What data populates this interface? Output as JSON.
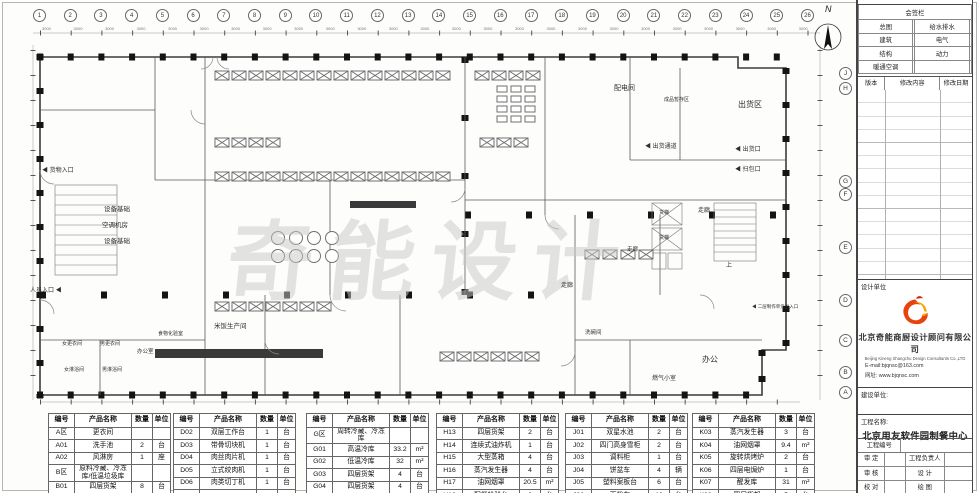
{
  "sheet": {
    "north_label": "N",
    "watermark": "奇能设计",
    "grid_top": [
      "1",
      "2",
      "3",
      "4",
      "5",
      "6",
      "7",
      "8",
      "9",
      "10",
      "11",
      "12",
      "13",
      "14",
      "15",
      "16",
      "17",
      "18",
      "19",
      "20",
      "21",
      "22",
      "23",
      "24",
      "25",
      "26"
    ],
    "dims": [
      "3000",
      "3000",
      "3000",
      "3000",
      "3000",
      "3000",
      "3000",
      "3000",
      "3000",
      "3000",
      "3000",
      "3000",
      "3000",
      "3000",
      "3000",
      "3000",
      "3000",
      "3000",
      "3000",
      "3000",
      "3000",
      "3000",
      "3000",
      "3000",
      "3000"
    ],
    "grid_right": [
      "J",
      "H",
      "G",
      "F",
      "E",
      "D",
      "C",
      "B",
      "A"
    ]
  },
  "plan": {
    "labels": {
      "power_room": "配电间",
      "product_storage": "成品暂存区",
      "shipping_area": "出货区",
      "shipping_channel": "◀ 出货通道",
      "shipping_port": "◀ 出货口",
      "pickup_port": "◀ 扫包口",
      "corridor1": "走廊",
      "corridor2": "走廊",
      "corridor3": "走廊",
      "freight_lift1": "货梯",
      "freight_lift2": "货梯",
      "stairs_up": "上",
      "office": "办公",
      "gas_room": "燃气小室",
      "unit_entrance": "◀ 二层制作单元出入口",
      "equip_base1": "设备基础",
      "ac_room": "空调机房",
      "equip_base2": "设备基础",
      "goods_entrance": "◀ 货物入口",
      "personnel_entrance": "人员入口 ◀",
      "women_changing": "女更衣间",
      "men_changing": "男更衣间",
      "women_shower": "女淋浴间",
      "men_shower": "男淋浴间",
      "office2": "办公室",
      "lab": "食物化验室",
      "rice_room": "米饭生产间",
      "dish_wash": "洗碗间"
    }
  },
  "equipment_tables": {
    "headers": [
      "编号",
      "产品名称",
      "数量",
      "单位"
    ],
    "tables": [
      {
        "rows": [
          [
            "A区",
            "更衣间",
            "",
            ""
          ],
          [
            "A01",
            "洗手池",
            "2",
            "台"
          ],
          [
            "A02",
            "风淋房",
            "1",
            "座"
          ],
          [
            "B区",
            "原料冷藏、冷冻库/低温垃圾库",
            "",
            ""
          ],
          [
            "B01",
            "四层货架",
            "8",
            "台"
          ]
        ]
      },
      {
        "rows": [
          [
            "D02",
            "双层工作台",
            "1",
            "台"
          ],
          [
            "D03",
            "带骨切块机",
            "1",
            "台"
          ],
          [
            "D04",
            "肉丝肉片机",
            "1",
            "台"
          ],
          [
            "D05",
            "立式绞肉机",
            "1",
            "台"
          ],
          [
            "D06",
            "肉类切丁机",
            "1",
            "台"
          ],
          [
            "",
            "",
            "",
            ""
          ]
        ]
      },
      {
        "rows": [
          [
            "G区",
            "周转冷藏、冷冻库",
            "",
            ""
          ],
          [
            "G01",
            "高温冷库",
            "33.2",
            "m²"
          ],
          [
            "G02",
            "低温冷库",
            "32",
            "m²"
          ],
          [
            "G03",
            "四层货架",
            "4",
            "台"
          ],
          [
            "G04",
            "四层货架",
            "4",
            "台"
          ]
        ]
      },
      {
        "rows": [
          [
            "H13",
            "四层货架",
            "2",
            "台"
          ],
          [
            "H14",
            "连续式油炸机",
            "1",
            "台"
          ],
          [
            "H15",
            "大型蒸箱",
            "4",
            "台"
          ],
          [
            "H16",
            "蒸汽发生器",
            "4",
            "台"
          ],
          [
            "H17",
            "油网烟罩",
            "20.5",
            "m²"
          ],
          [
            "H18",
            "配餐检验台",
            "2",
            "台"
          ]
        ]
      },
      {
        "rows": [
          [
            "J01",
            "双星水池",
            "2",
            "台"
          ],
          [
            "J02",
            "四门高身雪柜",
            "2",
            "台"
          ],
          [
            "J03",
            "调料柜",
            "1",
            "台"
          ],
          [
            "J04",
            "饼盆车",
            "4",
            "辆"
          ],
          [
            "J05",
            "塑料案板台",
            "6",
            "台"
          ],
          [
            "J06",
            "面粉车",
            "10",
            "台"
          ]
        ]
      },
      {
        "rows": [
          [
            "K03",
            "蒸汽发生器",
            "3",
            "台"
          ],
          [
            "K04",
            "油网烟罩",
            "9.4",
            "m²"
          ],
          [
            "K05",
            "旋转烘烤炉",
            "2",
            "台"
          ],
          [
            "K06",
            "四层电焗炉",
            "1",
            "台"
          ],
          [
            "K07",
            "醒发库",
            "31",
            "m²"
          ],
          [
            "K08",
            "四层货架",
            "5",
            "台"
          ]
        ]
      }
    ]
  },
  "titleblock": {
    "sign_header": "会签栏",
    "sign_rows": [
      [
        "总图",
        "给水排水"
      ],
      [
        "建筑",
        "电气"
      ],
      [
        "结构",
        "动力"
      ],
      [
        "暖通空调",
        ""
      ]
    ],
    "rev_headers": [
      "版本",
      "修改内容",
      "修改日期"
    ],
    "design_unit_label": "设计单位",
    "company_cn": "北京奇能商厨设计顾问有限公司",
    "company_en": "Beijing Kineng Shangchu Design Consultants Co.,LTD",
    "email": "E-mail:bjqnsc@163.com",
    "website": "网址: www.bjqnsc.com",
    "client_label": "建设单位:",
    "project_label": "工程名称:",
    "project_name": "北京用友软件园制餐中心",
    "project_no_label": "工程编号",
    "approve_label": "审 定",
    "check_label": "审 核",
    "proof_label": "校 对",
    "pm_label": "工程负责人",
    "design_label": "设 计",
    "draw_label": "绘 图"
  }
}
